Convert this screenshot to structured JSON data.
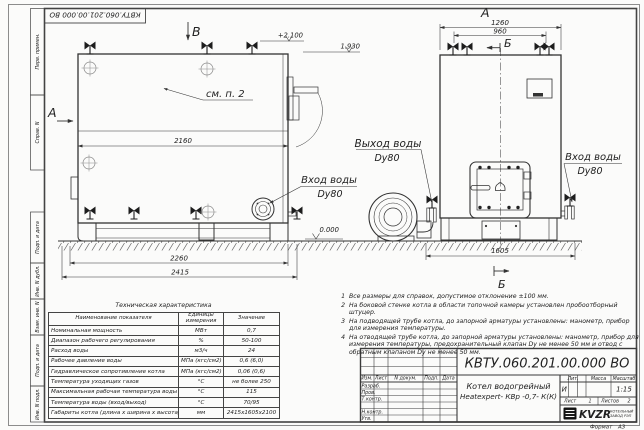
{
  "colors": {
    "ink": "#333333",
    "bg": "#fbfbfa"
  },
  "sheet": {
    "stamp_top": "КВТУ.060.201.00.000  ВО",
    "margin_labels": [
      "Перв. примен.",
      "Справ. N",
      "Подп. и дата",
      "Инв. N дубл.",
      "Взам. инв. N",
      "Подп. и дата",
      "Инв. N подл."
    ],
    "format_label": "Формат",
    "format_value": "А3"
  },
  "drawing": {
    "section_labels": {
      "v": "В",
      "a_side": "А",
      "a_front": "А",
      "b_front_top": "Б",
      "b_front_bottom": "Б"
    },
    "elevations": {
      "top": "+2.100",
      "mid": "1.930",
      "zero": "0.000"
    },
    "dims": {
      "d2160": "2160",
      "d2260": "2260",
      "d2415": "2415",
      "d1260": "1260",
      "d960": "960",
      "d1605": "1605"
    },
    "callouts": {
      "see_note": "см. п. 2",
      "outlet_title": "Выход воды",
      "outlet_dn": "Dy80",
      "inlet_side_title": "Вход воды",
      "inlet_side_dn": "Dy80",
      "inlet_front_title": "Вход воды",
      "inlet_front_dn": "Dy80"
    }
  },
  "tech_table": {
    "title": "Техническая характеристика",
    "headers": [
      "Наименование показателя",
      "Единицы измерения",
      "Значение"
    ],
    "rows": [
      [
        "Номинальная мощность",
        "МВт",
        "0,7"
      ],
      [
        "Диапазон рабочего регулирования",
        "%",
        "50-100"
      ],
      [
        "Расход воды",
        "м3/ч",
        "24"
      ],
      [
        "Рабочее давление воды",
        "МПа (кгс/см2)",
        "0,6 (6,0)"
      ],
      [
        "Гидравлическое сопротивление котла",
        "МПа (кгс/см2)",
        "0,06 (0,6)"
      ],
      [
        "Температура уходящих газов",
        "°С",
        "не более 250"
      ],
      [
        "Максимальная рабочая температура воды",
        "°С",
        "115"
      ],
      [
        "Температура воды (вход/выход)",
        "°С",
        "70/95"
      ],
      [
        "Габариты котла (длина х ширина х высота)",
        "мм",
        "2415х1605х2100"
      ]
    ]
  },
  "notes": [
    {
      "num": "1",
      "text": "Все размеры для справок, допустимое отклонение ±100 мм."
    },
    {
      "num": "2",
      "text": "На боковой стенке котла в области топочной камеры установлен пробоотборный штуцер."
    },
    {
      "num": "3",
      "text": "На  подводящей трубе котла, до запорной арматуры установлены: манометр, прибор для измерения температуры."
    },
    {
      "num": "4",
      "text": "На отводящей трубе котла, до запорной арматуры установлены: манометр, прибор для измерения температуры, предохранительный клапан Dу не менее 50 мм и отвод с обратным клапаном Dу не менее 50 мм."
    }
  ],
  "title_block": {
    "doc_number": "КВТУ.060.201.00.000  ВО",
    "header_cols": [
      "Изм.",
      "Лист",
      "N докум.",
      "Подп.",
      "Дата"
    ],
    "row_labels": [
      "Разраб.",
      "Пров.",
      "Т.контр.",
      "Н.контр.",
      "Утв."
    ],
    "name_line1": "Котел водогрейный",
    "name_line2": "Heatexpert- КВр -0,7- К(К)",
    "lit_label": "Лит.",
    "lit_value": "И",
    "mass_label": "Масса",
    "scale_label": "Масштаб",
    "scale_value": "1:15",
    "sheet_label": "Лист",
    "sheet_value": "1",
    "sheets_label": "Листов",
    "sheets_value": "2",
    "logo": {
      "text": "KVZR",
      "sub1": "КОТЕЛЬНЫЙ",
      "sub2": "ЗАВОД РЭП"
    }
  }
}
